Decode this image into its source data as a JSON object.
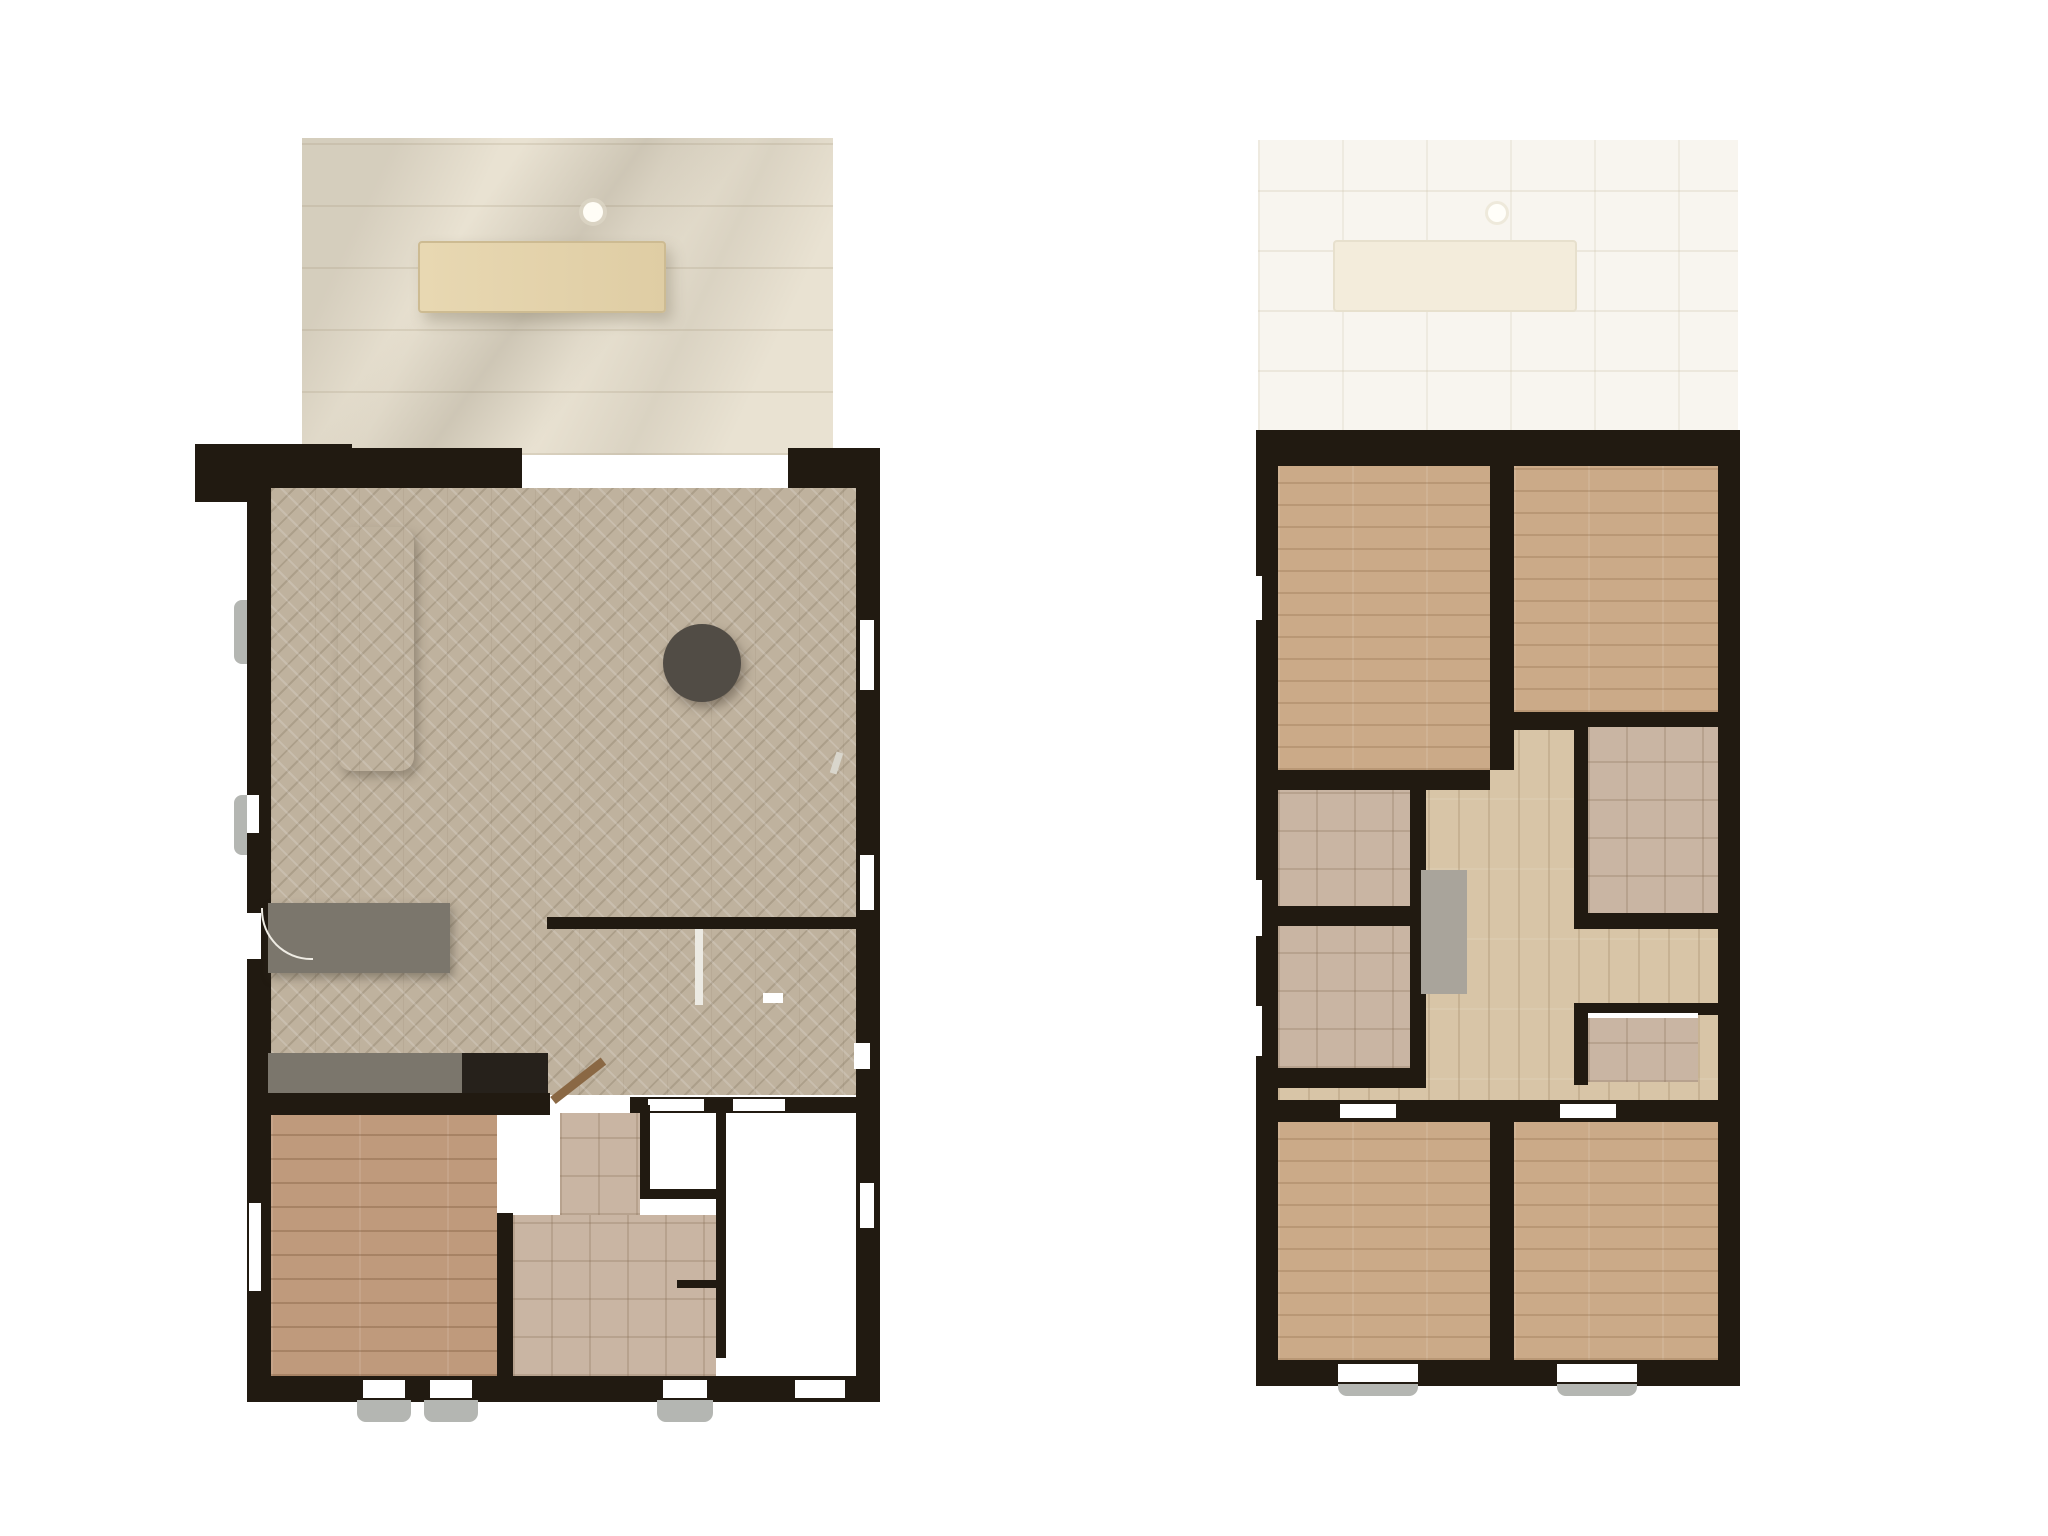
{
  "image": {
    "kind": "architectural-floorplan-rendering",
    "views": [
      {
        "id": "ground-floor",
        "position": "left"
      },
      {
        "id": "upper-floor",
        "position": "right"
      }
    ]
  },
  "palette": {
    "wall": "#211a11",
    "terrace": "#e9e2d2",
    "ghost": "#f8f5ef",
    "floor-herring": "#bfb29e",
    "floor-plank-left": "#bf9a7c",
    "floor-plank-right": "#cbaa88",
    "floor-hall": "#d8c5a7",
    "tile-bath": "#c9b5a3",
    "tile-dark": "#8d7663",
    "floor-utility": "#a7a298",
    "roof": "#978d7d",
    "roof-cap": "#f2efe7",
    "sofa": "#8f897c",
    "sofa-dark": "#7b7467",
    "table-gray": "#6f6b62",
    "chair-plum": "#7b5d6e",
    "chair-plum-dark": "#5e4556",
    "pillow-olive": "#a07f2d",
    "band-olive": "#8a7128",
    "bench-yellow": "#dca73e",
    "duvet": "#f3f1ea",
    "headboard": "#8d8076",
    "rug": "#c7b8bd",
    "counter": "#7b766c",
    "cooktop": "#15110d",
    "stool": "#c59f6e",
    "white-fix": "#f7f6f1",
    "stairs": "#d5d1c9",
    "door-panel": "#9b968b",
    "plant": "#5a8f46"
  },
  "ground_floor": {
    "areas": [
      "terrace",
      "living-room",
      "dining-area",
      "kitchen",
      "hallway",
      "bedroom",
      "bathroom",
      "toilet",
      "utility-room",
      "staircase"
    ],
    "furniture_counts": {
      "parasol": 1,
      "terrace_table": 1,
      "terrace_chairs": 7,
      "dining_table": 1,
      "dining_side_chairs": 8,
      "dining_head_chairs": 2,
      "fruit_bowl": 1,
      "corner_sofa": 1,
      "straight_sofa": 1,
      "coffee_table": 1,
      "side_tables": 3,
      "rug": 1,
      "tv_sideboard": 1,
      "kitchen_island": 1,
      "bar_stools": 2,
      "cooktop": 1,
      "sink": 1,
      "double_bed": 1,
      "bed_bench": 1,
      "bathtub": 1,
      "shower": 1,
      "washbasins": 2,
      "toilet": 1,
      "appliances": 2,
      "plant": 1,
      "radiator_grille": 1
    }
  },
  "upper_floor": {
    "areas": [
      "roof-slab-left",
      "roof-slab-right",
      "terrace-ghost",
      "bedroom-1",
      "bedroom-2",
      "bedroom-3",
      "bedroom-4",
      "shower-room-1",
      "shower-room-2",
      "bathroom",
      "toilet",
      "landing",
      "staircase",
      "wardrobe"
    ],
    "furniture_counts": {
      "double_beds": 4,
      "dressers": 4,
      "bedside_tables": 8,
      "showers": 2,
      "washbasins": 4,
      "toilet": 1,
      "wardrobe": 1,
      "ghost_parasol": 1,
      "ghost_table": 1,
      "ghost_chairs": 7
    }
  }
}
